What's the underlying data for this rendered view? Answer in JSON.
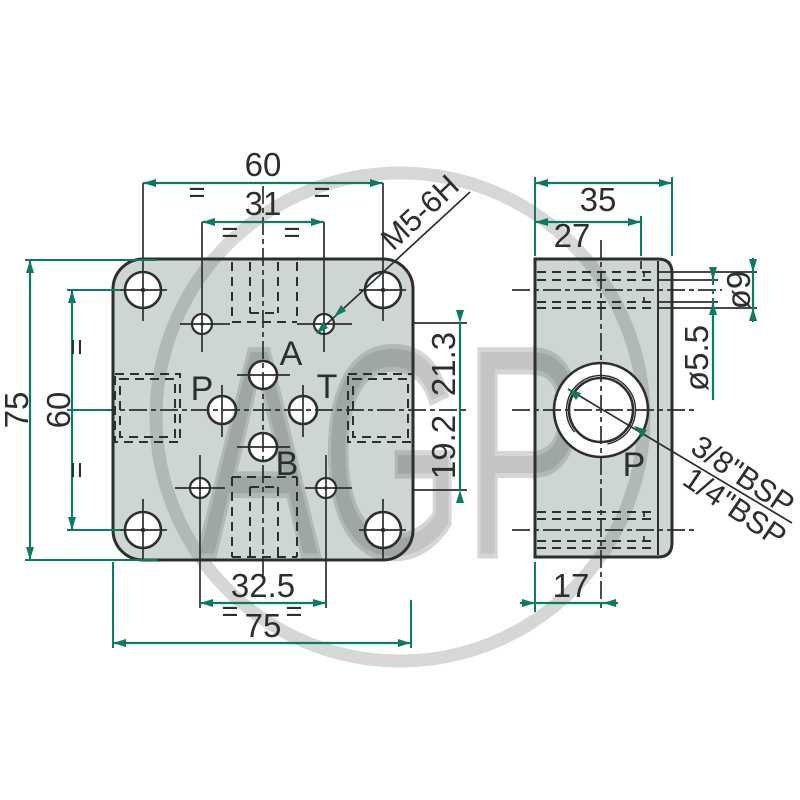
{
  "page": {
    "background": "#ffffff",
    "type": "technical-drawing"
  },
  "colors": {
    "accent": "#0d7b63",
    "line": "#2b2f2d",
    "plate_fill": "#cdd6d1",
    "watermark_gray": "#d9d9d9"
  },
  "watermark": {
    "text": "AGP"
  },
  "front_view": {
    "dim_width_outer": "60",
    "dim_width_inner": "31",
    "dim_height_outer": "75",
    "dim_height_inner": "60",
    "dim_right_upper": "21.3",
    "dim_right_lower": "19.2",
    "dim_bottom_inner": "32.5",
    "dim_bottom_outer": "75",
    "thread_callout": "M5-6H",
    "equal_mark": "=",
    "port_a": "A",
    "port_b": "B",
    "port_p": "P",
    "port_t": "T"
  },
  "side_view": {
    "dim_depth": "35",
    "dim_step": "27",
    "dim_counterbore": "ø9",
    "dim_through_hole": "ø5.5",
    "dim_port_offset": "17",
    "port_p": "P",
    "thread_option_1": "3/8\"BSP",
    "thread_option_2": "1/4\"BSP"
  }
}
